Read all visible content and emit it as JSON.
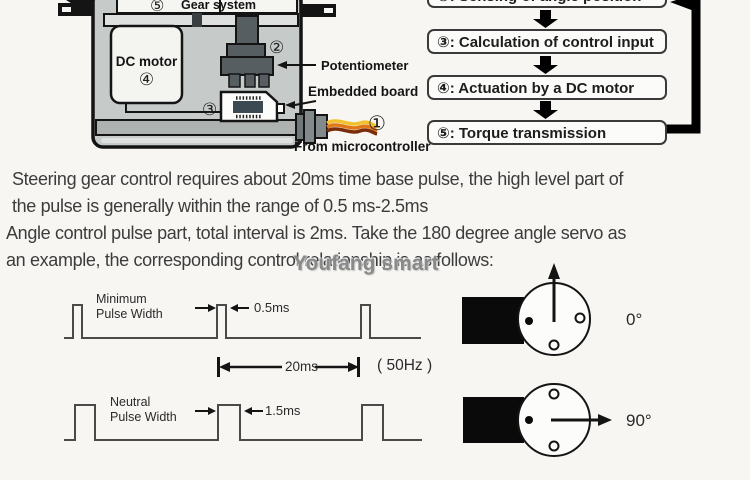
{
  "colors": {
    "background": "#f7f6f3",
    "servo_body": "#c6cbc9",
    "servo_bottom_band": "#aeb3b1",
    "potentiometer_dark": "#565e62",
    "chip_dark": "#3c4852",
    "wire_yellow": "#f2c12e",
    "wire_orange": "#e07818",
    "wire_brown": "#7a2d08",
    "waveform_line": "#4a4a4a",
    "flow_box_border": "#3a3a3a"
  },
  "servo": {
    "gear_num": "⑤",
    "gear_label": "Gear system",
    "motor_label": "DC motor",
    "motor_num": "④",
    "pot_num": "②",
    "pot_label": "Potentiometer",
    "board_num": "③",
    "board_label": "Embedded board",
    "cable_num": "①",
    "cable_label": "From microcontroller"
  },
  "flowchart": {
    "steps": [
      {
        "text": "②: Sensing of angle position"
      },
      {
        "text": "③: Calculation of control input"
      },
      {
        "text": "④: Actuation by a DC motor"
      },
      {
        "text": "⑤: Torque transmission"
      }
    ]
  },
  "paragraphs": {
    "p1": "Steering gear control requires about 20ms time base pulse, the high level part of\nthe pulse is generally within the range of 0.5 ms-2.5ms",
    "p2": "Angle control pulse part, total interval is 2ms. Take the 180 degree angle servo as\nan example, the corresponding control relationship is as follows:"
  },
  "watermark": "Youfang smart",
  "waveforms": {
    "minimum": {
      "name": "Minimum\nPulse Width",
      "width_label": "0.5ms"
    },
    "neutral": {
      "name": "Neutral\nPulse Width",
      "width_label": "1.5ms"
    },
    "period_label": "20ms",
    "frequency_label": "( 50Hz )"
  },
  "horns": {
    "angle_0": "0°",
    "angle_90": "90°"
  }
}
